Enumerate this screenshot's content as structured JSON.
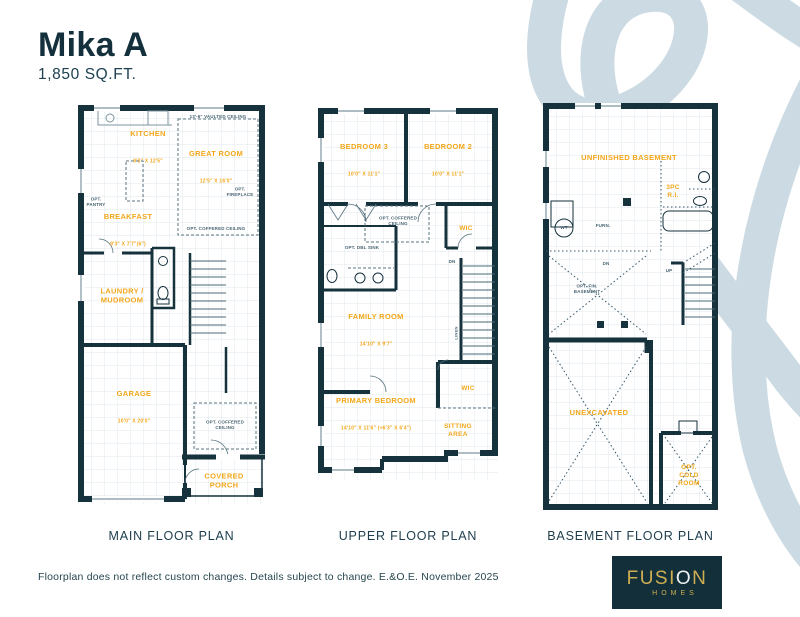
{
  "header": {
    "title": "Mika A",
    "subtitle": "1,850 SQ.FT."
  },
  "plans": {
    "main": {
      "caption": "MAIN FLOOR PLAN",
      "rooms": {
        "kitchen": {
          "name": "KITCHEN",
          "dims": "9'3\" X 12'5\""
        },
        "great_room": {
          "name": "GREAT ROOM",
          "dims": "12'5\" X 16'0\""
        },
        "breakfast": {
          "name": "BREAKFAST",
          "dims": "9'3\" X 7'7\"(6\")"
        },
        "laundry": {
          "name": "LAUNDRY /\nMUDROOM"
        },
        "garage": {
          "name": "GARAGE",
          "dims": "10'0\" X 20'0\""
        },
        "porch": {
          "name": "COVERED\nPORCH"
        }
      },
      "notes": {
        "vaulted": "13'-6\" VAULTED CEILING",
        "pantry": "OPT.\nPANTRY",
        "fireplace": "OPT.\nFIREPLACE",
        "coffered_great": "OPT. COFFERED CEILING",
        "coffered_foyer": "OPT. COFFERED\nCEILING"
      }
    },
    "upper": {
      "caption": "UPPER FLOOR PLAN",
      "rooms": {
        "bedroom3": {
          "name": "BEDROOM 3",
          "dims": "10'0\" X 11'1\""
        },
        "bedroom2": {
          "name": "BEDROOM 2",
          "dims": "10'0\" X 11'1\""
        },
        "wic1": {
          "name": "WIC"
        },
        "family": {
          "name": "FAMILY ROOM",
          "dims": "14'10\" X 9'7\""
        },
        "wic2": {
          "name": "WIC"
        },
        "primary": {
          "name": "PRIMARY BEDROOM",
          "dims": "14'10\" X 11'6\" (+6'3\" X 6'4\")"
        },
        "sitting": {
          "name": "SITTING\nAREA"
        }
      },
      "notes": {
        "coffered": "OPT. COFFERED\nCEILING",
        "dbl_sink": "OPT. DBL SINK",
        "dn": "DN",
        "linen": "LINEN"
      }
    },
    "basement": {
      "caption": "BASEMENT FLOOR PLAN",
      "rooms": {
        "unfinished": {
          "name": "UNFINISHED BASEMENT"
        },
        "three_pc": {
          "name": "3PC\nR.I."
        },
        "unexcavated": {
          "name": "UNEXCAVATED"
        },
        "cold_room": {
          "name": "OPT.\nCOLD\nROOM"
        }
      },
      "notes": {
        "furn": "FURN.",
        "wt": "WT",
        "opt_fin": "OPT. FIN.\nBASEMENT",
        "dn": "DN",
        "up": "UP"
      }
    }
  },
  "footer": {
    "disclaimer": "Floorplan does not reflect custom changes. Details subject to change. E.&O.E. November 2025"
  },
  "logo": {
    "part1": "FUSI",
    "accent": "O",
    "part2": "N",
    "sub": "HOMES"
  },
  "colors": {
    "navy": "#15323e",
    "gold": "#f2a71b",
    "swoosh": "#ccdbe3",
    "logo_bg": "#122f3a",
    "logo_gold": "#cfae52"
  }
}
